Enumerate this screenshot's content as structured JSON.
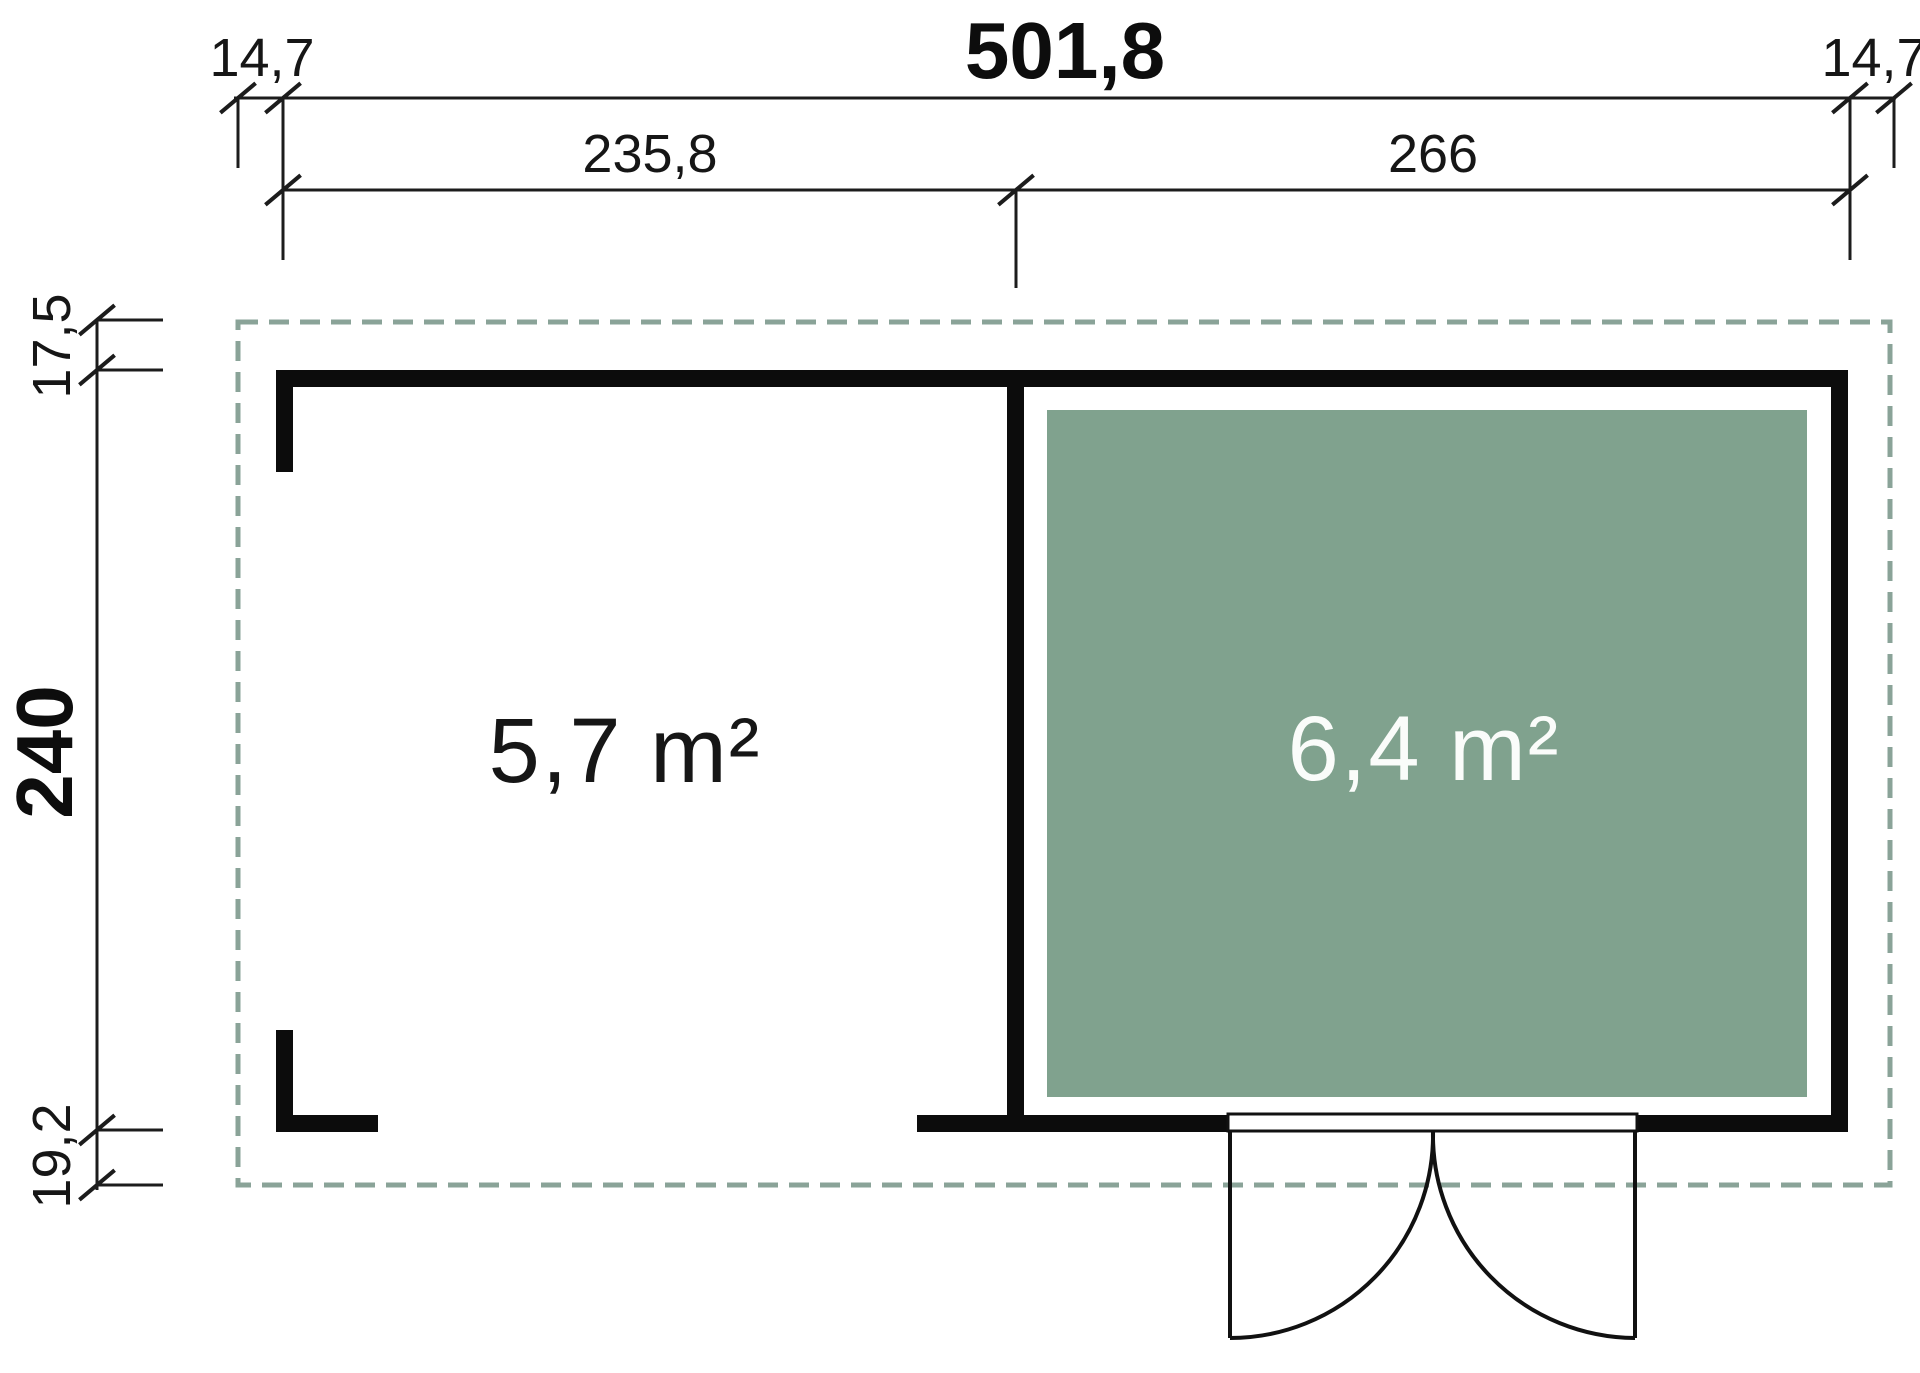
{
  "dimensions_top": {
    "overhang_left": "14,7",
    "overall_width": "501,8",
    "overhang_right": "14,7",
    "left_section_width": "235,8",
    "right_section_width": "266"
  },
  "dimensions_left": {
    "roof_overhang_top": "17,5",
    "overall_depth": "240",
    "roof_overhang_bottom": "19,2"
  },
  "rooms": {
    "canopy": {
      "area": "5,7 m²"
    },
    "cabin": {
      "area": "6,4 m²"
    }
  },
  "colors": {
    "wall": "#0c0c0c",
    "dimension_line": "#1c1c1c",
    "roof_outline": "#8aa398",
    "floor": "#80a28e",
    "label_dark": "#161616",
    "label_light": "#fafcfa",
    "door_line": "#111111",
    "background": "#ffffff"
  }
}
